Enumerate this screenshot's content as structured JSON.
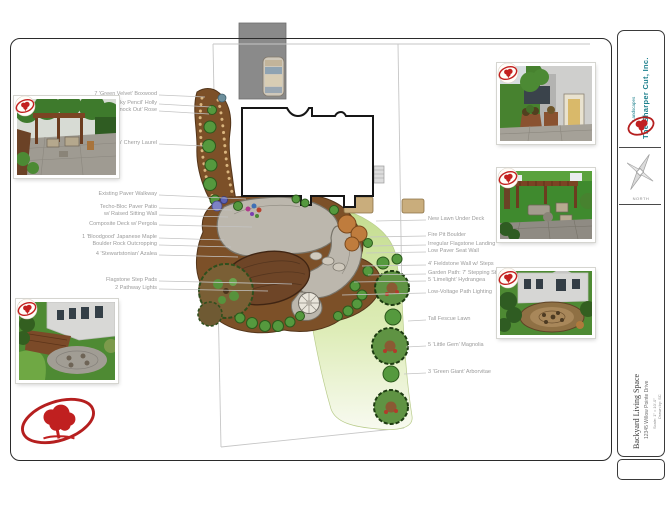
{
  "sheet": {
    "company": {
      "name": "The Sharper Cut, Inc.",
      "tagline": "Landscapes",
      "north_label": "NORTH"
    },
    "title_block": {
      "project": "Backyard Living Space",
      "address": "12345 Willow Pointe Drive",
      "scale": "Scale: 1\" = 10'-0\"",
      "drawn": "Drawn by: SC"
    },
    "icons": {
      "company_logo": "red-oval-tree-logo",
      "stamp": "red-oval-tree-stamp",
      "compass": "north-arrow-compass"
    },
    "colors": {
      "brand_teal": "#1b7f8c",
      "brand_red": "#c3201f",
      "lawn_green": "#c3dc8e",
      "mulch_brown": "#7c5028",
      "patio_gray": "#bcb7ad"
    }
  },
  "plan": {
    "labels_left": [
      "7 'Green Velvet' Boxwood",
      "3 'Sky Pencil' Holly",
      "5 'Knock Out' Rose",
      "5 'Otto Luyken' Cherry Laurel",
      "Existing Paver Walkway",
      "Techo-Bloc Paver Patio",
      "w/ Raised Sitting Wall",
      "Composite Deck w/ Pergola",
      "1 'Bloodgood' Japanese Maple",
      "Boulder Rock Outcropping",
      "4 'Stewartstonian' Azalea",
      "Flagstone Step Pads",
      "2 Pathway Lights"
    ],
    "labels_right": [
      "New Lawn Under Deck",
      "Fire Pit Boulder",
      "Irregular Flagstone Landing",
      "Low Paver Seat Wall",
      "4' Fieldstone Wall w/ Steps",
      "Garden Path: 7' Stepping Stones",
      "5 'Limelight' Hydrangea",
      "Low-Voltage Path Lighting",
      "Tall Fescue Lawn",
      "5 'Little Gem' Magnolia",
      "3 'Green Giant' Arborvitae"
    ]
  }
}
